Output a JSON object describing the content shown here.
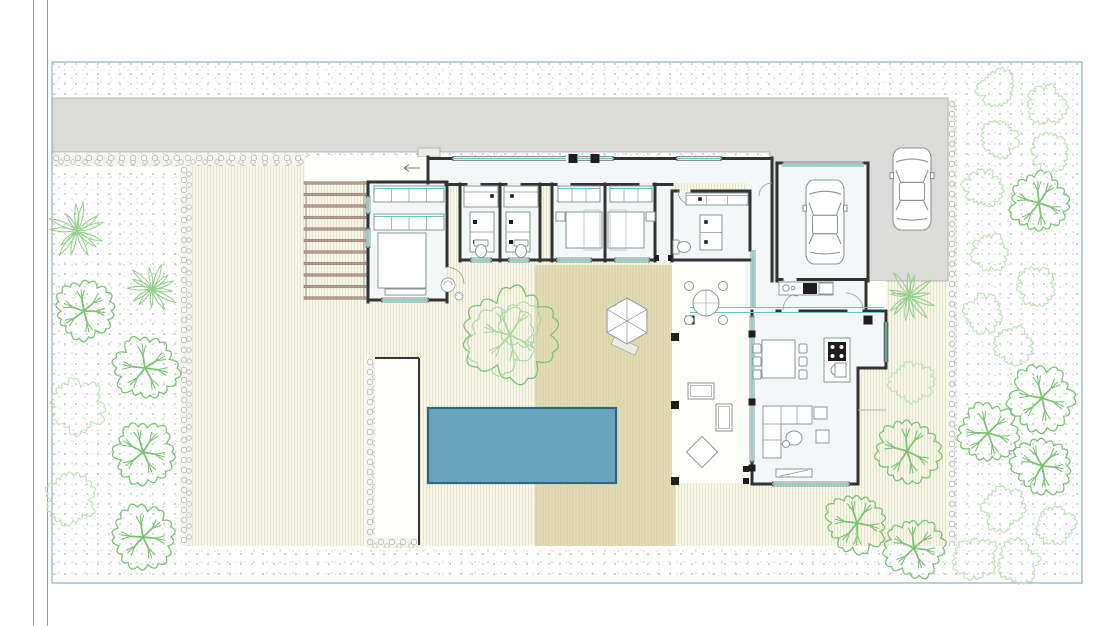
{
  "canvas": {
    "w": 1110,
    "h": 626
  },
  "colors": {
    "boundary": "#8ab4c2",
    "road": "#9a9a9a",
    "wall": "#333333",
    "wall_thin": "#6b6f70",
    "furn": "#8f9494",
    "furn_light": "#bcc0c0",
    "teal": "#66c8bc",
    "driveway": "#dbdcda",
    "driveway_edge": "#a5a8a5",
    "room": "#f3f7f7",
    "white_floor": "#fcfcf9",
    "pool": "#68a4bb",
    "pool_edge": "#2f6880",
    "pergola": "#b39a8d",
    "pergola_edge": "#8d7a70",
    "tree": "#79c472",
    "tree_light": "#a9d89b",
    "palm": "#8ed084",
    "bush": "#c2e1b8",
    "black": "#1e1e1e",
    "step": "#b5b5b5",
    "arrow": "#777777"
  },
  "road_lines": [
    33.5,
    47.5
  ],
  "boundary": {
    "x": 52,
    "y": 62,
    "w": 1030,
    "h": 521
  },
  "ground": {
    "stipple": [
      52,
      62,
      1030,
      521
    ],
    "lawn": [
      192,
      166,
      756,
      380
    ],
    "patio": [
      535,
      265,
      140,
      281
    ],
    "pebbles": [
      [
        52,
        154,
        258,
        12
      ],
      [
        180,
        166,
        12,
        380
      ],
      [
        948,
        100,
        9,
        446
      ],
      [
        366,
        358,
        9,
        182
      ],
      [
        366,
        538,
        53,
        10
      ]
    ],
    "driveway_points": "52,98 948,98 948,281 770,281 770,152 52,152",
    "white_strip": [
      305,
      157,
      123,
      26
    ],
    "terrace": [
      672,
      262,
      80,
      221
    ],
    "porch": [
      866,
      281,
      20,
      30
    ],
    "gravel_strip": [
      375,
      358,
      44,
      180
    ],
    "stoop": [
      418,
      148,
      22,
      9
    ],
    "garden_walls": [
      [
        419,
        358,
        419,
        545
      ],
      [
        375,
        358,
        419,
        358
      ]
    ],
    "step_line": [
      858,
      410,
      886,
      410
    ]
  },
  "house": {
    "rooms": [
      [
        428,
        160,
        344,
        23
      ],
      [
        745,
        160,
        27,
        151
      ],
      [
        368,
        182,
        79,
        120
      ],
      [
        460,
        184,
        80,
        78
      ],
      [
        552,
        184,
        103,
        78
      ],
      [
        655,
        184,
        17,
        78
      ],
      [
        672,
        191,
        78,
        71
      ],
      [
        777,
        163,
        91,
        118
      ],
      [
        752,
        281,
        116,
        30
      ]
    ],
    "living_path": "M752,311 H886 V368 H858 V484 H752 Z",
    "walls": [
      [
        368,
        182,
        447,
        182
      ],
      [
        368,
        182,
        368,
        196
      ],
      [
        368,
        214,
        368,
        228
      ],
      [
        368,
        248,
        368,
        302
      ],
      [
        368,
        300,
        381,
        300
      ],
      [
        429,
        300,
        447,
        300
      ],
      [
        447,
        182,
        447,
        266
      ],
      [
        447,
        284,
        447,
        302
      ],
      [
        428,
        157,
        428,
        183
      ],
      [
        428,
        158.5,
        452,
        158.5
      ],
      [
        614,
        158.5,
        676,
        158.5
      ],
      [
        722,
        158.5,
        772,
        158.5
      ],
      [
        446,
        184.5,
        466,
        184.5
      ],
      [
        482,
        184.5,
        506,
        184.5
      ],
      [
        522,
        184.5,
        556,
        184.5
      ],
      [
        572,
        184.5,
        638,
        184.5
      ],
      [
        654,
        184.5,
        672,
        184.5
      ],
      [
        460,
        184,
        460,
        261
      ],
      [
        500,
        184,
        500,
        261
      ],
      [
        540,
        184,
        540,
        261
      ],
      [
        460,
        260,
        470,
        260
      ],
      [
        492,
        260,
        508,
        260
      ],
      [
        530,
        260,
        552,
        260
      ],
      [
        552,
        184,
        552,
        261
      ],
      [
        605,
        184,
        605,
        261
      ],
      [
        655,
        184,
        655,
        261
      ],
      [
        552,
        260,
        556,
        260
      ],
      [
        592,
        260,
        614,
        260
      ],
      [
        650,
        260,
        655,
        260
      ],
      [
        672,
        191,
        678,
        191
      ],
      [
        692,
        191,
        750,
        191
      ],
      [
        672,
        191,
        672,
        261
      ],
      [
        672,
        260,
        750,
        260
      ],
      [
        750,
        191,
        750,
        250
      ],
      [
        772,
        158,
        772,
        281
      ],
      [
        777,
        163,
        782,
        163
      ],
      [
        864,
        163,
        868,
        163
      ],
      [
        777,
        163,
        777,
        281
      ],
      [
        868,
        163,
        868,
        281
      ],
      [
        777,
        279.5,
        782,
        279.5
      ],
      [
        798,
        279.5,
        868,
        279.5
      ],
      [
        866,
        281,
        866,
        311
      ],
      [
        777,
        311,
        780,
        311
      ],
      [
        800,
        311,
        846,
        311
      ],
      [
        864,
        311,
        867,
        311
      ],
      [
        867,
        311,
        886,
        311
      ],
      [
        886,
        311,
        886,
        368
      ],
      [
        858,
        368,
        886,
        368
      ],
      [
        858,
        368,
        858,
        484
      ],
      [
        752,
        484,
        772,
        484
      ],
      [
        850,
        484,
        858,
        484
      ],
      [
        752,
        311,
        752,
        316
      ],
      [
        752,
        462,
        752,
        484
      ]
    ],
    "windows": [
      [
        452,
        158.5,
        566,
        158.5
      ],
      [
        578,
        158.5,
        614,
        158.5
      ],
      [
        676,
        158.5,
        722,
        158.5
      ],
      [
        368,
        196,
        368,
        214
      ],
      [
        368,
        228,
        368,
        248
      ],
      [
        381,
        300,
        429,
        300
      ],
      [
        470,
        260,
        492,
        260
      ],
      [
        508,
        260,
        530,
        260
      ],
      [
        556,
        260,
        592,
        260
      ],
      [
        614,
        260,
        650,
        260
      ],
      [
        782,
        164,
        864,
        164
      ],
      [
        753,
        250,
        753,
        308
      ],
      [
        752,
        316,
        752,
        462
      ],
      [
        772,
        484,
        850,
        484
      ],
      [
        886,
        322,
        886,
        362
      ]
    ],
    "walk_lines": [
      [
        690,
        307.5,
        884,
        307.5
      ],
      [
        690,
        312.5,
        884,
        312.5
      ]
    ],
    "posts": [
      [
        573,
        158.5,
        9
      ],
      [
        595,
        158.5,
        9
      ]
    ],
    "pillars": [
      [
        690,
        320,
        9
      ],
      [
        868,
        320,
        9
      ]
    ],
    "columns": [
      [
        675,
        337,
        8
      ],
      [
        675,
        405,
        8
      ],
      [
        675,
        481,
        8
      ]
    ],
    "mullions": [
      [
        752,
        334,
        7
      ],
      [
        752,
        402,
        7
      ],
      [
        752,
        468,
        7
      ]
    ],
    "jambs": [
      [
        655,
        255,
        4,
        6
      ],
      [
        668,
        255,
        4,
        6
      ],
      [
        743,
        466,
        6,
        6
      ],
      [
        743,
        478,
        6,
        6
      ]
    ],
    "door_arcs": [
      [
        466,
        185,
        16,
        0,
        90
      ],
      [
        522,
        185,
        16,
        90,
        180
      ],
      [
        556,
        185,
        16,
        0,
        90
      ],
      [
        654,
        185,
        16,
        90,
        180
      ],
      [
        692,
        191,
        14,
        90,
        180
      ],
      [
        447,
        284,
        17,
        -90,
        0
      ],
      [
        798,
        280,
        16,
        90,
        180
      ],
      [
        800,
        310,
        17,
        180,
        270
      ],
      [
        846,
        310,
        17,
        270,
        360
      ],
      [
        772,
        196,
        13,
        180,
        270
      ]
    ],
    "entry_arrow": [
      420,
      168,
      404,
      168
    ]
  },
  "furniture": {
    "wardrobes": [
      [
        374,
        186,
        70,
        16,
        4
      ],
      [
        374,
        214,
        70,
        16,
        4
      ],
      [
        558,
        186,
        42,
        16,
        3
      ],
      [
        610,
        186,
        42,
        16,
        3
      ],
      [
        686,
        193,
        62,
        12,
        3
      ]
    ],
    "beds": [
      {
        "x": 378,
        "y": 233,
        "w": 48,
        "h": 55,
        "side": "top"
      },
      {
        "x": 566,
        "y": 212,
        "w": 36,
        "h": 36,
        "side": "right"
      },
      {
        "x": 608,
        "y": 212,
        "w": 36,
        "h": 36,
        "side": "left"
      }
    ],
    "bench": [
      385,
      289,
      41,
      6
    ],
    "nightstands": [
      [
        556,
        212,
        9,
        9
      ],
      [
        646,
        212,
        9,
        9
      ]
    ],
    "desks": [
      [
        584,
        210,
        16,
        40
      ],
      [
        610,
        210,
        16,
        40
      ]
    ],
    "vanities": [
      [
        464,
        186,
        34,
        21
      ],
      [
        504,
        186,
        34,
        21
      ]
    ],
    "vanity_dots": [
      [
        492,
        196
      ],
      [
        512,
        196
      ],
      [
        706,
        222
      ],
      [
        706,
        242
      ],
      [
        700,
        199
      ]
    ],
    "bath_cabinets": [
      [
        470,
        212,
        24,
        40
      ],
      [
        506,
        212,
        24,
        40
      ]
    ],
    "vanity3": [
      700,
      215,
      22,
      35
    ],
    "toilets": [
      {
        "cx": 481,
        "cy": 250,
        "rot": 0
      },
      {
        "cx": 521,
        "cy": 250,
        "rot": 0
      },
      {
        "cx": 683,
        "cy": 247,
        "rot": -90
      }
    ],
    "counter": {
      "x": 779,
      "y": 282,
      "w": 54,
      "h": 13,
      "sink": [
        786,
        288
      ],
      "black_box": [
        803,
        283,
        14,
        11
      ],
      "gray_box": [
        819,
        283,
        14,
        11
      ]
    },
    "island": {
      "x": 824,
      "y": 338,
      "w": 26,
      "h": 44,
      "stove": [
        828,
        342,
        18,
        19
      ],
      "sink": [
        837,
        370,
        6,
        5.5
      ]
    },
    "dining": {
      "x": 762,
      "y": 340,
      "w": 33,
      "h": 38,
      "chairs": [
        [
          753,
          344
        ],
        [
          753,
          357
        ],
        [
          753,
          370
        ],
        [
          799,
          344
        ],
        [
          799,
          357
        ],
        [
          799,
          370
        ]
      ]
    },
    "sofa_path": "M763,406 h49 v18 h-31 v34 h-18 z",
    "sofa_lines": [
      [
        781,
        406,
        781,
        424
      ],
      [
        797,
        406,
        797,
        424
      ],
      [
        763,
        424,
        781,
        424
      ],
      [
        763,
        440,
        781,
        440
      ]
    ],
    "coffee": {
      "cx": 794,
      "cy": 438,
      "rx": 8,
      "ry": 7,
      "dot": [
        786,
        444,
        3.5
      ]
    },
    "side_tables": [
      [
        814,
        407,
        13,
        12
      ],
      [
        816,
        430,
        13,
        13
      ],
      [
        835,
        363,
        11,
        14
      ]
    ],
    "tv_bench": [
      776,
      469,
      36,
      8
    ],
    "round_table": {
      "cx": 706,
      "cy": 303,
      "r": 13,
      "chair_r": 4.5,
      "chair_d": 17
    },
    "lounge_rects": [
      [
        688,
        383,
        26,
        16
      ],
      [
        716,
        404,
        16,
        27
      ]
    ],
    "diamond": {
      "cx": 702,
      "cy": 452,
      "r": 11
    },
    "decos": [
      [
        448,
        285,
        7
      ],
      [
        459,
        296,
        4
      ]
    ]
  },
  "pool": {
    "x": 428,
    "y": 408,
    "w": 188,
    "h": 75
  },
  "parasol": {
    "cx": 627,
    "cy": 321,
    "r": 23,
    "base": [
      615,
      336,
      26,
      9,
      25
    ]
  },
  "pergola": {
    "x1": 304,
    "x2": 366,
    "y0": 183,
    "step": 11.5,
    "count": 11,
    "rails": [
      306,
      364
    ],
    "ry0": 181,
    "ry1": 300
  },
  "cars": [
    [
      806,
      180,
      38,
      84
    ],
    [
      893,
      148,
      38,
      82
    ]
  ],
  "trees": [
    {
      "t": "palm",
      "x": 77,
      "y": 231,
      "r": 28
    },
    {
      "t": "palm",
      "x": 152,
      "y": 289,
      "r": 26
    },
    {
      "t": "palm",
      "x": 909,
      "y": 296,
      "r": 26
    },
    {
      "t": "tree",
      "x": 84,
      "y": 311,
      "r": 26
    },
    {
      "t": "tree",
      "x": 145,
      "y": 368,
      "r": 28
    },
    {
      "t": "tree",
      "x": 143,
      "y": 452,
      "r": 27
    },
    {
      "t": "tree",
      "x": 143,
      "y": 537,
      "r": 27
    },
    {
      "t": "tree",
      "x": 907,
      "y": 451,
      "r": 28
    },
    {
      "t": "tree",
      "x": 857,
      "y": 523,
      "r": 27
    },
    {
      "t": "tree",
      "x": 914,
      "y": 548,
      "r": 26
    },
    {
      "t": "tree",
      "x": 988,
      "y": 433,
      "r": 27
    },
    {
      "t": "tree",
      "x": 1042,
      "y": 398,
      "r": 28
    },
    {
      "t": "tree",
      "x": 1042,
      "y": 466,
      "r": 26
    },
    {
      "t": "tree",
      "x": 1039,
      "y": 203,
      "r": 27
    },
    {
      "t": "bigtree",
      "x": 510,
      "y": 335,
      "r": 40
    },
    {
      "t": "bush",
      "x": 78,
      "y": 407,
      "r": 24
    },
    {
      "t": "bush",
      "x": 70,
      "y": 500,
      "r": 22
    },
    {
      "t": "bush",
      "x": 911,
      "y": 382,
      "r": 19
    },
    {
      "t": "bush",
      "x": 997,
      "y": 88,
      "r": 17
    },
    {
      "t": "bush",
      "x": 1046,
      "y": 104,
      "r": 17
    },
    {
      "t": "bush",
      "x": 1000,
      "y": 138,
      "r": 16
    },
    {
      "t": "bush",
      "x": 1051,
      "y": 152,
      "r": 17
    },
    {
      "t": "bush",
      "x": 983,
      "y": 188,
      "r": 17
    },
    {
      "t": "bush",
      "x": 989,
      "y": 252,
      "r": 16
    },
    {
      "t": "bush",
      "x": 1037,
      "y": 287,
      "r": 17
    },
    {
      "t": "bush",
      "x": 984,
      "y": 314,
      "r": 17
    },
    {
      "t": "bush",
      "x": 1014,
      "y": 346,
      "r": 17
    },
    {
      "t": "bush",
      "x": 1003,
      "y": 508,
      "r": 19
    },
    {
      "t": "bush",
      "x": 1055,
      "y": 525,
      "r": 17
    },
    {
      "t": "bush",
      "x": 977,
      "y": 558,
      "r": 19
    },
    {
      "t": "bush",
      "x": 1018,
      "y": 562,
      "r": 18
    }
  ]
}
